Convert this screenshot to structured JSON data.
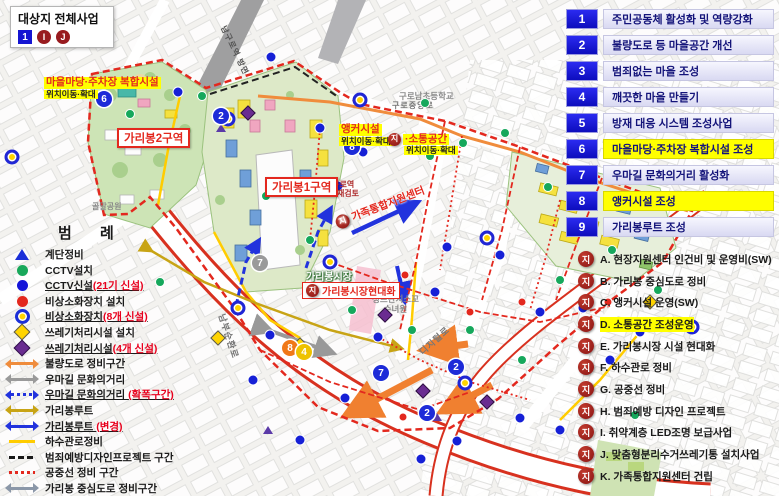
{
  "title_box": {
    "title": "대상지 전체사업",
    "num_mark": "1",
    "circle_mark_1": "I",
    "circle_mark_2": "J"
  },
  "ji_badge": "지",
  "projects": [
    {
      "num": "1",
      "label": "주민공동체 활성화 및 역량강화"
    },
    {
      "num": "2",
      "label": "불량도로 등 마을공간 개선"
    },
    {
      "num": "3",
      "label": "범죄없는 마을 조성"
    },
    {
      "num": "4",
      "label": "깨끗한 마을 만들기"
    },
    {
      "num": "5",
      "label": "방재 대응 시스템 조성사업"
    },
    {
      "num": "6",
      "label": "마을마당·주차장 복합시설 조성"
    },
    {
      "num": "7",
      "label": "우마길 문화의거리 활성화"
    },
    {
      "num": "8",
      "label": "앵커시설 조성"
    },
    {
      "num": "9",
      "label": "가리봉루트 조성"
    }
  ],
  "sub_projects": [
    {
      "label": "A. 현장지원센터 인건비 및 운영비(SW)"
    },
    {
      "label": "B. 가리봉 중심도로 정비"
    },
    {
      "label": "C. 앵커시설 운영(SW)"
    },
    {
      "label": "D. 소통공간 조성운영"
    },
    {
      "label": "E. 가리봉시장 시설 현대화"
    },
    {
      "label": "F. 하수관로 정비"
    },
    {
      "label": "G. 공중선 정비"
    },
    {
      "label": "H. 범죄예방 디자인 프로젝트"
    },
    {
      "label": "I. 취약계층 LED조명 보급사업"
    },
    {
      "label": "J. 맞춤형분리수거쓰레기통 설치사업"
    },
    {
      "label": "K. 가족통합지원센터 건립"
    }
  ],
  "legend": {
    "title": "범 례",
    "items": [
      {
        "label": "계단정비"
      },
      {
        "label": "CCTV설치"
      },
      {
        "label": "CCTV신설",
        "red": "(21기 신설)"
      },
      {
        "label": "비상소화장치 설치"
      },
      {
        "label": "비상소화장치",
        "red": "(8개 신설)"
      },
      {
        "label": "쓰레기처리시설 설치"
      },
      {
        "label": "쓰레기처리시설",
        "red": "(4개 신설)"
      },
      {
        "label": "불량도로 정비구간"
      },
      {
        "label": "우마길 문화의거리"
      },
      {
        "label": "우마길 문화의거리 ",
        "red": "(확폭구간)"
      },
      {
        "label": "가리봉루트"
      },
      {
        "label": "가리봉루트 ",
        "red": "(변경)"
      },
      {
        "label": "하수관로정비"
      },
      {
        "label": "범죄예방디자인프로젝트 구간"
      },
      {
        "label": "공중선 정비 구간"
      },
      {
        "label": "가리봉 중심도로 정비구간"
      }
    ]
  },
  "map": {
    "labels": {
      "village_hall_1": "마을마당·주차장 복합시설",
      "village_hall_2": "위치이동·확대",
      "anchor_1": "앵커시설",
      "anchor_2": "위치이동·확대",
      "sotong_1": "·소통공간",
      "sotong_2": "위치이동·확대",
      "gari2": "가리봉2구역",
      "gari1": "가리봉1구역",
      "market_modern": "가리봉시장현대화",
      "market": "가리봉시장",
      "namguro_1": "남구로역",
      "namguro_2": "규모 재검토",
      "gajok": "가족통합지원센터",
      "francisco_1": "성프란치스꼬",
      "francisco_2": "수녀원",
      "school": "구로남초등학교",
      "park": "골말공원",
      "road_nambu": "남부순환로",
      "road_digital": "디지털로",
      "road_guro": "구로중앙로",
      "station_dir": "남구로역 방면"
    },
    "markers": [
      [
        "blue",
        178,
        92
      ],
      [
        "blue",
        271,
        57
      ],
      [
        "blue",
        320,
        128
      ],
      [
        "blue",
        338,
        186
      ],
      [
        "blue",
        363,
        152
      ],
      [
        "blue",
        447,
        247
      ],
      [
        "blue",
        435,
        292
      ],
      [
        "blue",
        270,
        335
      ],
      [
        "blue",
        345,
        398
      ],
      [
        "blue",
        378,
        337
      ],
      [
        "blue",
        421,
        459
      ],
      [
        "blue",
        457,
        441
      ],
      [
        "blue",
        520,
        418
      ],
      [
        "blue",
        560,
        430
      ],
      [
        "blue",
        610,
        360
      ],
      [
        "blue",
        640,
        332
      ],
      [
        "blue",
        583,
        308
      ],
      [
        "blue",
        540,
        312
      ],
      [
        "blue",
        500,
        255
      ],
      [
        "blue",
        300,
        440
      ],
      [
        "blue",
        253,
        380
      ],
      [
        "green",
        130,
        114
      ],
      [
        "green",
        202,
        96
      ],
      [
        "green",
        425,
        103
      ],
      [
        "green",
        505,
        133
      ],
      [
        "green",
        463,
        143
      ],
      [
        "green",
        548,
        187
      ],
      [
        "green",
        576,
        226
      ],
      [
        "green",
        310,
        240
      ],
      [
        "green",
        266,
        196
      ],
      [
        "green",
        352,
        310
      ],
      [
        "green",
        412,
        330
      ],
      [
        "green",
        470,
        330
      ],
      [
        "green",
        560,
        280
      ],
      [
        "green",
        612,
        250
      ],
      [
        "green",
        658,
        290
      ],
      [
        "green",
        430,
        156
      ],
      [
        "green",
        522,
        360
      ],
      [
        "green",
        635,
        415
      ],
      [
        "green",
        160,
        282
      ],
      [
        "yring",
        12,
        157
      ],
      [
        "yring",
        228,
        119
      ],
      [
        "yring",
        330,
        262
      ],
      [
        "yring",
        487,
        238
      ],
      [
        "yring",
        465,
        383
      ],
      [
        "yring",
        692,
        327
      ],
      [
        "yring",
        238,
        308
      ],
      [
        "yring",
        360,
        100
      ],
      [
        "red",
        405,
        275
      ],
      [
        "red",
        470,
        312
      ],
      [
        "red",
        522,
        302
      ],
      [
        "red",
        403,
        417
      ],
      [
        "red",
        608,
        302
      ],
      [
        "ydia",
        300,
        345
      ],
      [
        "ydia",
        218,
        338
      ],
      [
        "ydia",
        650,
        302
      ],
      [
        "pdia",
        248,
        113
      ],
      [
        "pdia",
        385,
        315
      ],
      [
        "pdia",
        423,
        391
      ],
      [
        "pdia",
        487,
        402
      ],
      [
        "tri",
        221,
        128
      ],
      [
        "tri",
        437,
        417
      ],
      [
        "tri",
        268,
        430
      ]
    ],
    "badges": [
      [
        "6",
        104,
        99,
        "blue"
      ],
      [
        "2",
        221,
        116,
        "blue"
      ],
      [
        "8",
        352,
        147,
        "blue"
      ],
      [
        "7",
        260,
        263,
        "gray"
      ],
      [
        "8",
        290,
        348,
        "orange"
      ],
      [
        "4",
        304,
        352,
        "gold"
      ],
      [
        "7",
        381,
        373,
        "blue"
      ],
      [
        "2",
        456,
        367,
        "blue"
      ],
      [
        "2",
        427,
        413,
        "blue"
      ]
    ]
  }
}
